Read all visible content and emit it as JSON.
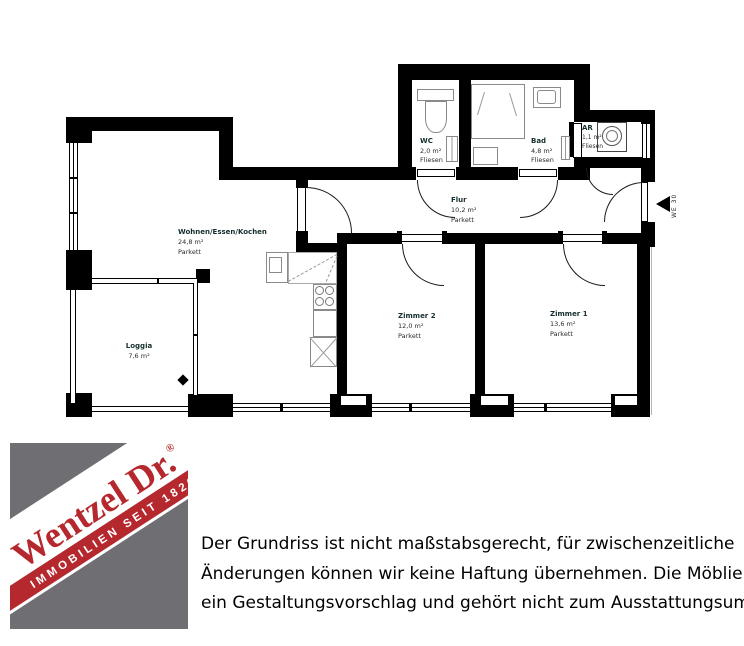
{
  "floor_plan": {
    "rooms": [
      {
        "name": "Wohnen/Essen/Kochen",
        "area": "24,8 m²",
        "floor": "Parkett"
      },
      {
        "name": "Loggia",
        "area": "7,6 m²",
        "floor": ""
      },
      {
        "name": "WC",
        "area": "2,0 m²",
        "floor": "Fliesen"
      },
      {
        "name": "Bad",
        "area": "4,8 m²",
        "floor": "Fliesen"
      },
      {
        "name": "AR",
        "area": "1,1 m²",
        "floor": "Fliesen"
      },
      {
        "name": "Flur",
        "area": "10,2 m²",
        "floor": "Parkett"
      },
      {
        "name": "Zimmer 2",
        "area": "12,0 m²",
        "floor": "Parkett"
      },
      {
        "name": "Zimmer 1",
        "area": "13,6 m²",
        "floor": "Parkett"
      }
    ],
    "entrance_label": "WE 30"
  },
  "logo": {
    "brand": "Wentzel Dr.",
    "registered": "®",
    "tagline": "IMMOBILIEN SEIT 1820",
    "colors": {
      "gray": "#6f6e72",
      "red": "#b5282e"
    }
  },
  "disclaimer": {
    "lines": [
      "Der Grundriss ist nicht maßstabsgerecht, für zwischenzeitliche",
      "Änderungen können wir keine Haftung übernehmen. Die Möblierung ist",
      "ein Gestaltungsvorschlag und gehört nicht zum Ausstattungsumfang."
    ]
  }
}
